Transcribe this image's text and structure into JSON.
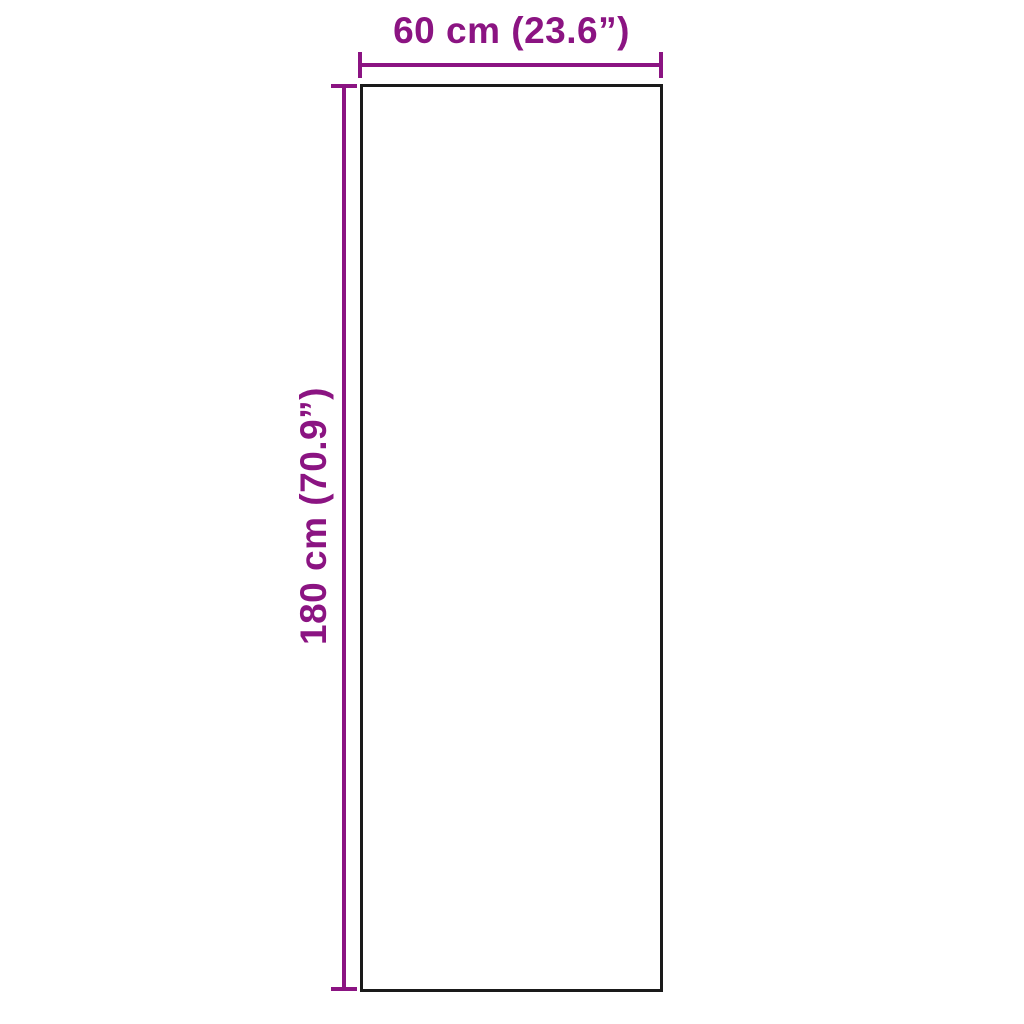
{
  "diagram": {
    "type": "product-dimension-drawing",
    "shape": "rectangle",
    "width_label": "60 cm (23.6”)",
    "height_label": "180 cm (70.9”)",
    "dimensions": {
      "width_cm": 60,
      "height_cm": 180,
      "width_in": 23.6,
      "height_in": 70.9
    },
    "colors": {
      "accent": "#8B1482",
      "outline": "#1a1a1a",
      "background": "#ffffff"
    }
  }
}
